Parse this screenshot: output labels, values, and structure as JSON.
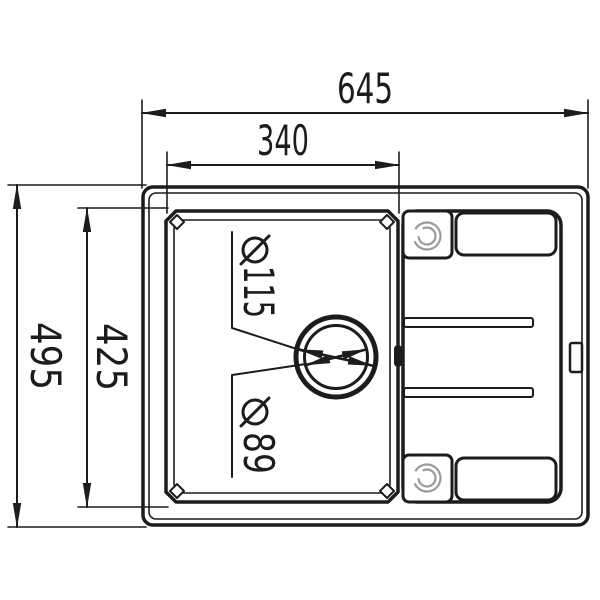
{
  "drawing": {
    "title": "Sink top-view technical drawing",
    "dimensions": {
      "overall_width": {
        "value": "645",
        "orientation": "horizontal"
      },
      "bowl_width": {
        "value": "340",
        "orientation": "horizontal"
      },
      "overall_depth": {
        "value": "495",
        "orientation": "vertical-rotated-90"
      },
      "bowl_depth": {
        "value": "425",
        "orientation": "vertical-rotated-90"
      },
      "drain_outer_diameter": {
        "symbol": "⌀",
        "value": "115",
        "label": "⌀115"
      },
      "drain_inner_diameter": {
        "symbol": "⌀",
        "value": "89",
        "label": "⌀89"
      }
    },
    "colors": {
      "line": "#1c1c1c",
      "faucet_circle": "#9a9a9a",
      "background": "#ffffff"
    }
  }
}
